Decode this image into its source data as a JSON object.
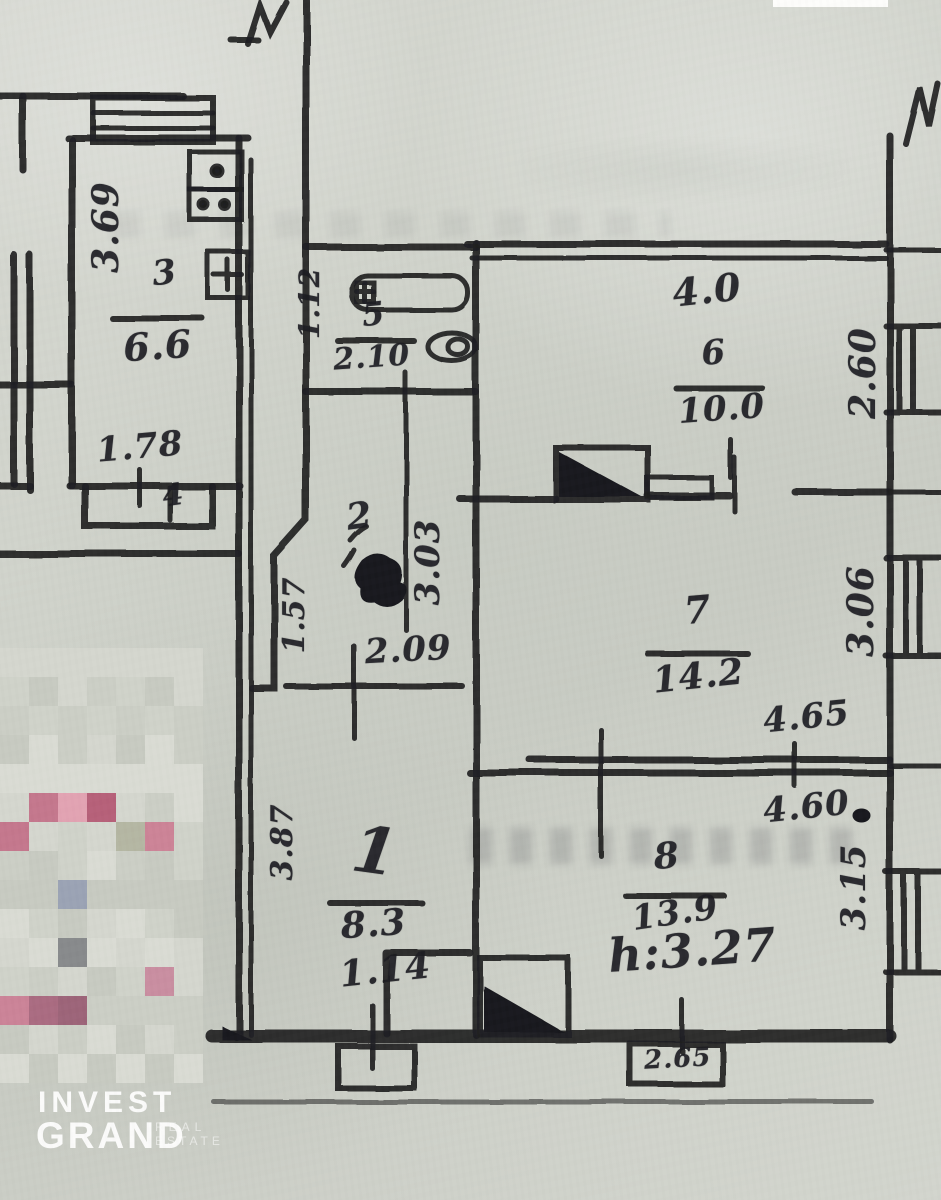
{
  "rooms": {
    "kitchen": {
      "number": "3",
      "area": "6.6"
    },
    "balcony": {
      "number": "4"
    },
    "bath": {
      "number": "5",
      "area": "2.10"
    },
    "hall": {
      "number": "2"
    },
    "living": {
      "number": "1",
      "area": "8.3"
    },
    "r6": {
      "number": "6",
      "area": "10.0",
      "top_width": "4.0"
    },
    "r7": {
      "number": "7",
      "area": "14.2"
    },
    "r8": {
      "number": "8",
      "area": "13.9",
      "height_note": "h:3.27"
    }
  },
  "dimensions": {
    "kitchen_left": "3.69",
    "kitchen_bottom": "1.78",
    "bath_left": "1.12",
    "hall_left": "1.57",
    "hall_right": "3.03",
    "hall_bottom": "2.09",
    "living_left": "3.87",
    "living_bottom": "1.14",
    "r7_bottom": "4.65",
    "r8_top": "4.60",
    "r8_bottom": "2.65",
    "right_top": "2.60",
    "right_mid": "3.06",
    "right_low": "3.15"
  },
  "logo": {
    "line1": "INVEST",
    "line2": "GRAND",
    "sub1": "REAL",
    "sub2": "ESTATE"
  },
  "colors": {
    "ink": "#1b1b20",
    "paper": "#cfd1ca",
    "logo_text": "#ffffff"
  },
  "censor": {
    "x": 0,
    "y": 648,
    "cols": 7,
    "rows": 15,
    "cell": 29,
    "greys": [
      "#d4d6ce",
      "#cbcec5",
      "#d9dbd3",
      "#cfd2c9",
      "#c7cac1"
    ],
    "overrides": [
      {
        "r": 5,
        "c": 1,
        "color": "#c4768c"
      },
      {
        "r": 5,
        "c": 2,
        "color": "#e2a2b2"
      },
      {
        "r": 5,
        "c": 3,
        "color": "#b65f78"
      },
      {
        "r": 6,
        "c": 0,
        "color": "#c4768c"
      },
      {
        "r": 6,
        "c": 4,
        "color": "#b4b6a2"
      },
      {
        "r": 6,
        "c": 5,
        "color": "#cc8296"
      },
      {
        "r": 8,
        "c": 2,
        "color": "#9aa2b4"
      },
      {
        "r": 10,
        "c": 2,
        "color": "#87898b"
      },
      {
        "r": 11,
        "c": 5,
        "color": "#c98da0"
      },
      {
        "r": 12,
        "c": 0,
        "color": "#cb8297"
      },
      {
        "r": 12,
        "c": 1,
        "color": "#a96a80"
      },
      {
        "r": 12,
        "c": 2,
        "color": "#9c6378"
      }
    ]
  }
}
